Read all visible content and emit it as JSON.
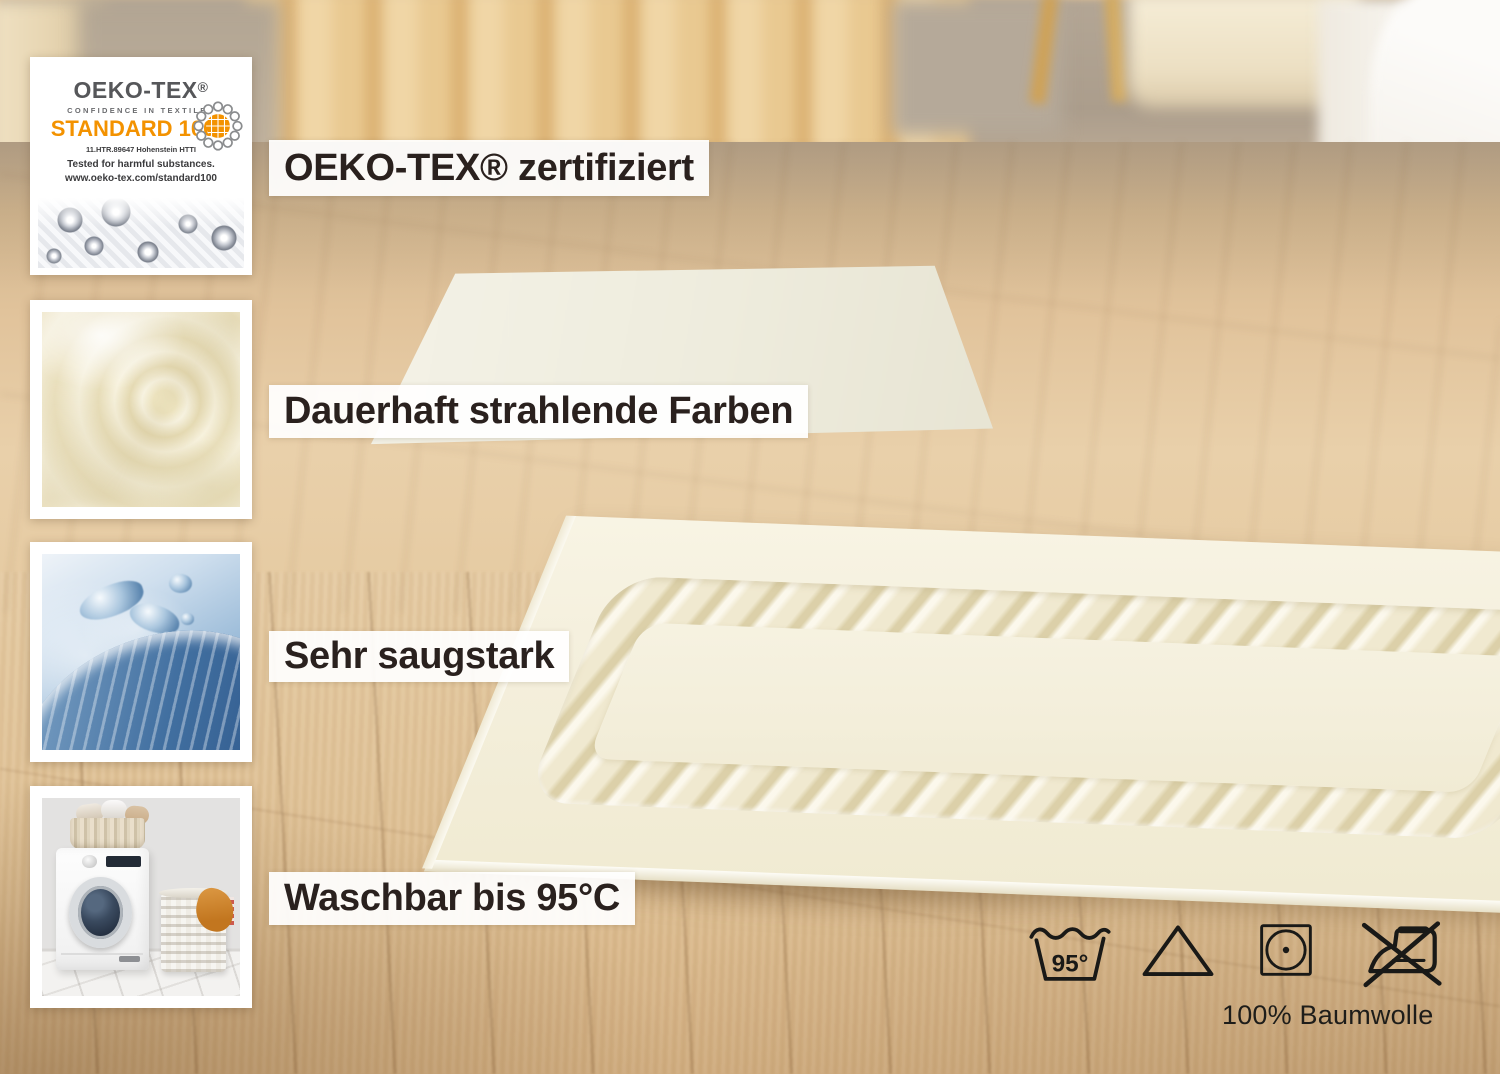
{
  "features": [
    {
      "label": "OEKO-TEX® zertifiziert",
      "thumbnail": "oeko-tex-standard-100-certificate"
    },
    {
      "label": "Dauerhaft strahlende Farben",
      "thumbnail": "cream-terry-towel-fabric"
    },
    {
      "label": "Sehr saugstark",
      "thumbnail": "splashing-water"
    },
    {
      "label": "Waschbar bis 95°C",
      "thumbnail": "washing-machine-with-laundry-baskets"
    }
  ],
  "certificate": {
    "brand": "OEKO-TEX",
    "registered": "®",
    "tagline": "CONFIDENCE IN TEXTILES",
    "standard": "STANDARD 100",
    "license": "11.HTR.89647 Hohenstein HTTI",
    "tested": "Tested for harmful substances.",
    "url": "www.oeko-tex.com/standard100"
  },
  "care": {
    "wash_temperature": "95°",
    "material": "100% Baumwolle",
    "symbols": [
      {
        "name": "wash-95-icon"
      },
      {
        "name": "bleach-triangle-icon"
      },
      {
        "name": "tumble-dry-icon"
      },
      {
        "name": "do-not-iron-icon"
      }
    ]
  },
  "colors": {
    "accent_orange": "#F39200",
    "label_text": "#2A211E",
    "symbol_ink": "#191917",
    "mat_cream": "#F4EFDC",
    "floor_wood": "#DDBE95",
    "water_blue": "#4B79A8"
  }
}
